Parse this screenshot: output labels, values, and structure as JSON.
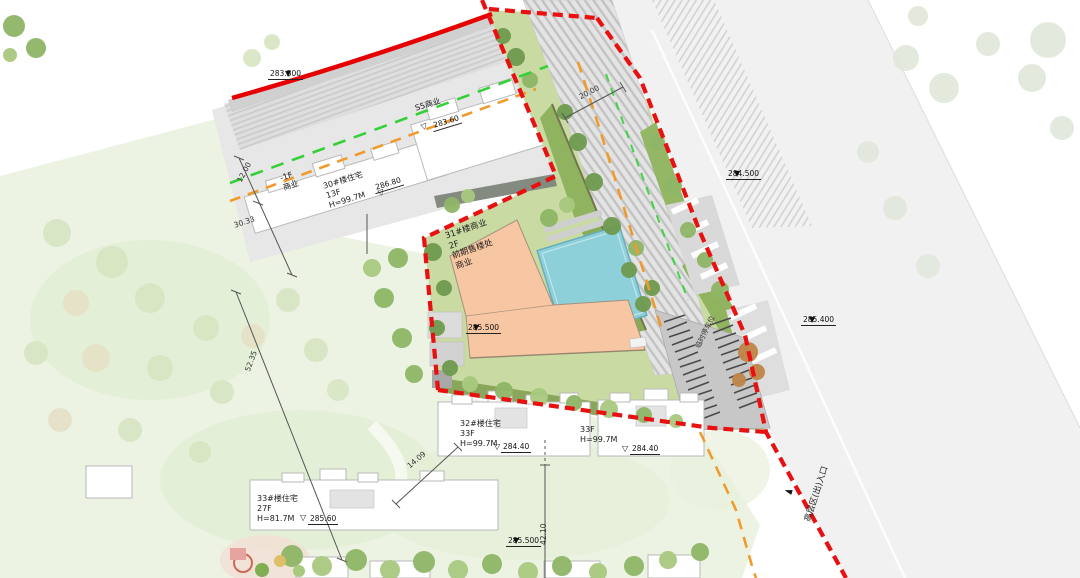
{
  "colors": {
    "boundary_red": "#e60000",
    "setback_orange": "#f19a2c",
    "greenline_green": "#35d038",
    "building_fill": "#f7c6a2",
    "pool_blue": "#8ed0da",
    "site_green": "#c9dba2",
    "road_gray": "#e6e6e6"
  },
  "buildings": {
    "s5": {
      "label": "S5商业",
      "elevation": "283.60"
    },
    "minus1f": {
      "label": "-1F\n商业"
    },
    "b30": {
      "label": "30#楼住宅\n13F\nH=99.7M",
      "elevation": "286.80"
    },
    "b31": {
      "label": "31#楼商业\n2F\n前期售楼处\n商业",
      "elevation": "285.500"
    },
    "b32": {
      "label": "32#楼住宅\n33F\nH=99.7M",
      "elevation": "284.40"
    },
    "b33f": {
      "label": "33F\nH=99.7M",
      "elevation": "284.40"
    },
    "b33": {
      "label": "33#楼住宅\n27F\nH=81.7M",
      "elevation": "285.60"
    }
  },
  "elevations": {
    "road_top": "283.500",
    "road_right_upper": "284.500",
    "road_right_lower": "285.400",
    "site_south": "285.500"
  },
  "dimensions": {
    "d12": "12.00",
    "d3033": "30.33",
    "d5235": "52.35",
    "d1409": "14.09",
    "d4210": "42.10",
    "d2000": "20.00"
  },
  "annotations": {
    "parking": "临时停车位",
    "entrance": "高层区(出)入口"
  },
  "icons": {
    "marker_filled": "▼",
    "marker_open": "▽",
    "entrance_arrow": "◄"
  }
}
